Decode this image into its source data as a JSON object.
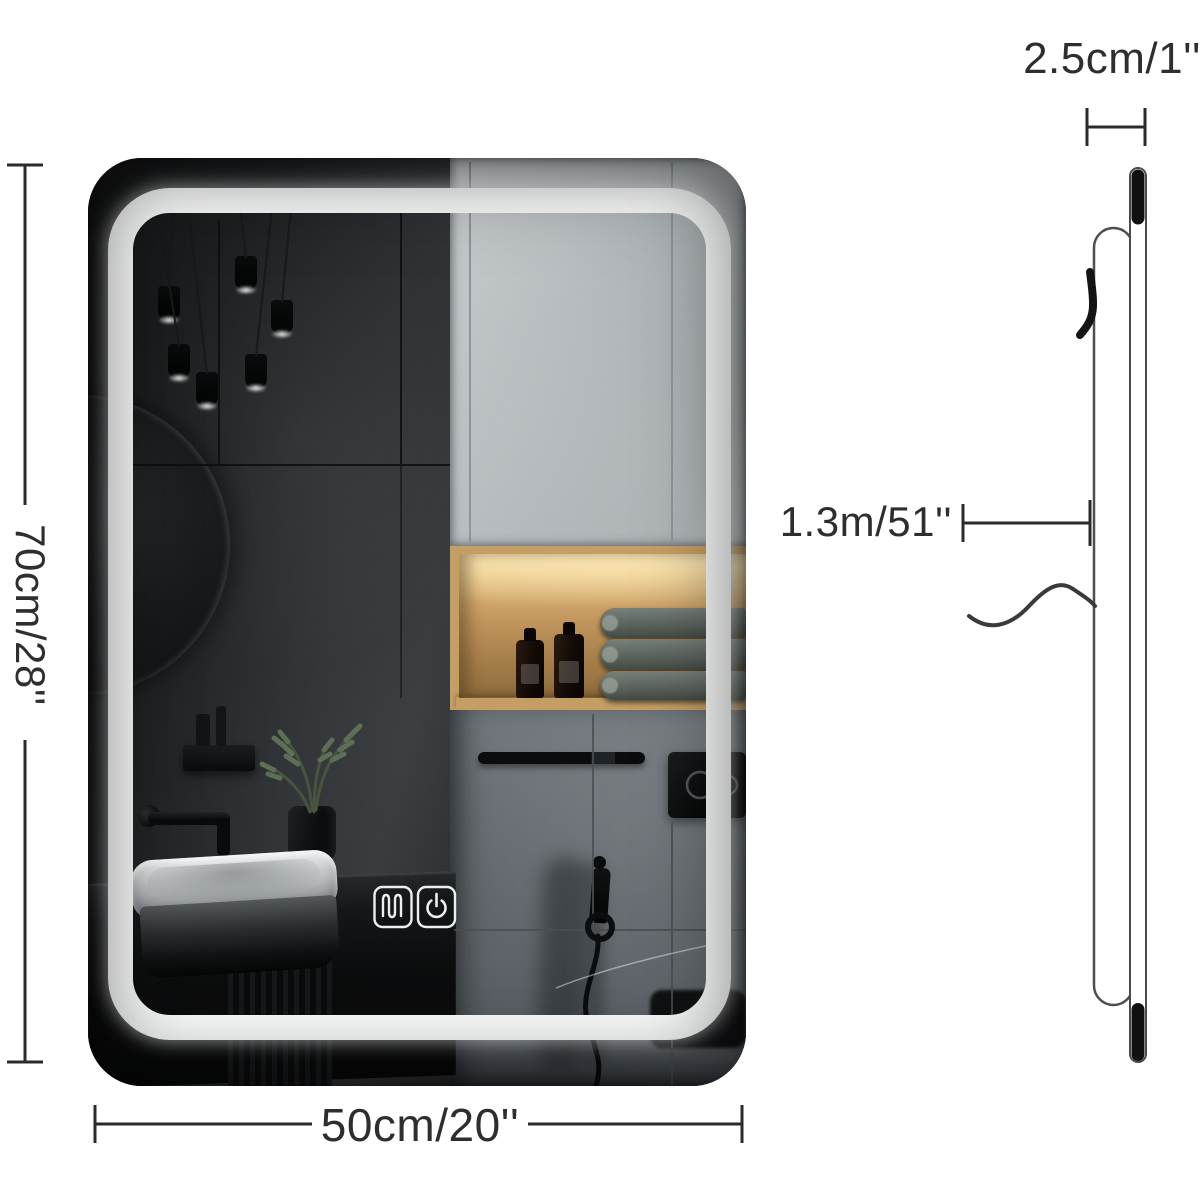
{
  "page": {
    "background": "#ffffff"
  },
  "labels": {
    "height": "70cm/28''",
    "width": "50cm/20''",
    "thickness": "2.5cm/1''",
    "length": "1.3m/51''"
  },
  "mirror": {
    "controls": [
      {
        "icon": "defog-icon"
      },
      {
        "icon": "power-icon"
      }
    ],
    "led_color": "#ffffff"
  },
  "colors": {
    "dimension_line": "#2b2b2b",
    "label_text": "#2e2e2e",
    "wall_dark": "#232527",
    "cabinet_gray": "#aeb3b6",
    "wood_shelf": "#c49e63",
    "tile_gray": "#62676b"
  }
}
